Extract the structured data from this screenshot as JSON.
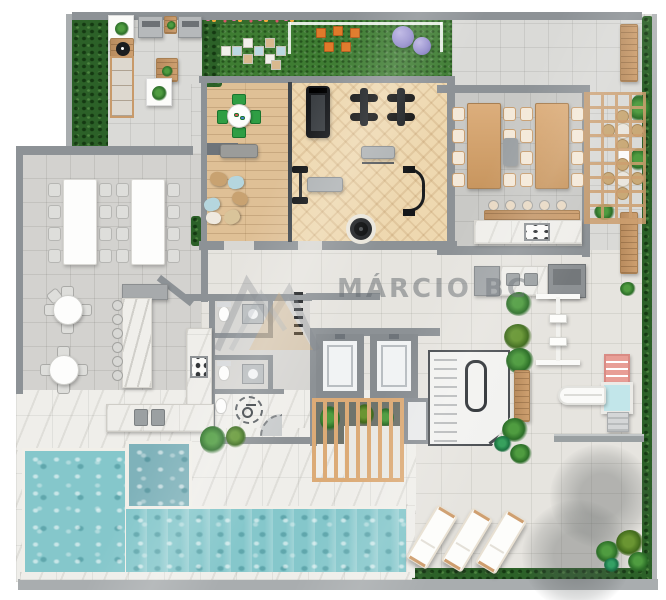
{
  "watermark": {
    "text": "MÁRCIO BC"
  },
  "palette": {
    "page_bg": "#ffffff",
    "wall": "#8d9296",
    "wall_dark": "#6e747a",
    "wall_light": "#a9adaf",
    "tile_light": "#dadad7",
    "tile_beige": "#e6e4df",
    "tile_gray": "#d3d2cf",
    "dining_floor": "#c9c9c6",
    "marble": "#efeeea",
    "grass": "#3e7c32",
    "hedge": "#2c6128",
    "wood_floor": "#dfc096",
    "gym_floor": "#eed8b0",
    "wood": "#cd9f6f",
    "wood_dark": "#b98c5e",
    "pool": "#85c7cb",
    "spa": "#7fb2ba",
    "pool_lip": "#f1efe9",
    "white_furniture": "#fdfdfc",
    "chair": "#dededb",
    "green_chair": "#2f9e44",
    "orange": "#e07a2a",
    "purple": "#9089cb",
    "equip": "#1e2124",
    "slide_blue": "#c2e6ea",
    "slide_pink": "#e89e96",
    "watermark_text": "rgba(98,104,110,0.5)",
    "logo_gray": "#7e848b",
    "logo_gold": "#dca85f"
  },
  "inventory": {
    "areas": [
      "barbecue-terrace",
      "kids-lawn",
      "games-lounge",
      "fitness-room",
      "gourmet-dining",
      "pergola-patio",
      "party-hall",
      "bar-lounge",
      "support-kitchen",
      "restrooms",
      "accessible-restroom",
      "elevator-core",
      "staircase",
      "pool",
      "spa-pool",
      "pool-deck",
      "kids-playground",
      "sun-deck"
    ],
    "counts": {
      "long_party_tables": 2,
      "party_chairs": 16,
      "wood_dining_tables": 2,
      "dining_chairs": 16,
      "round_tables": 2,
      "bar_stools": 6,
      "island_stools": 5,
      "patio_sets": 2,
      "grills": 2,
      "elevators": 2,
      "toilets": 3,
      "exercise_balls": 2,
      "sun_loungers": 3,
      "bean_bags": 6,
      "swings": 2,
      "slides": 1
    }
  }
}
